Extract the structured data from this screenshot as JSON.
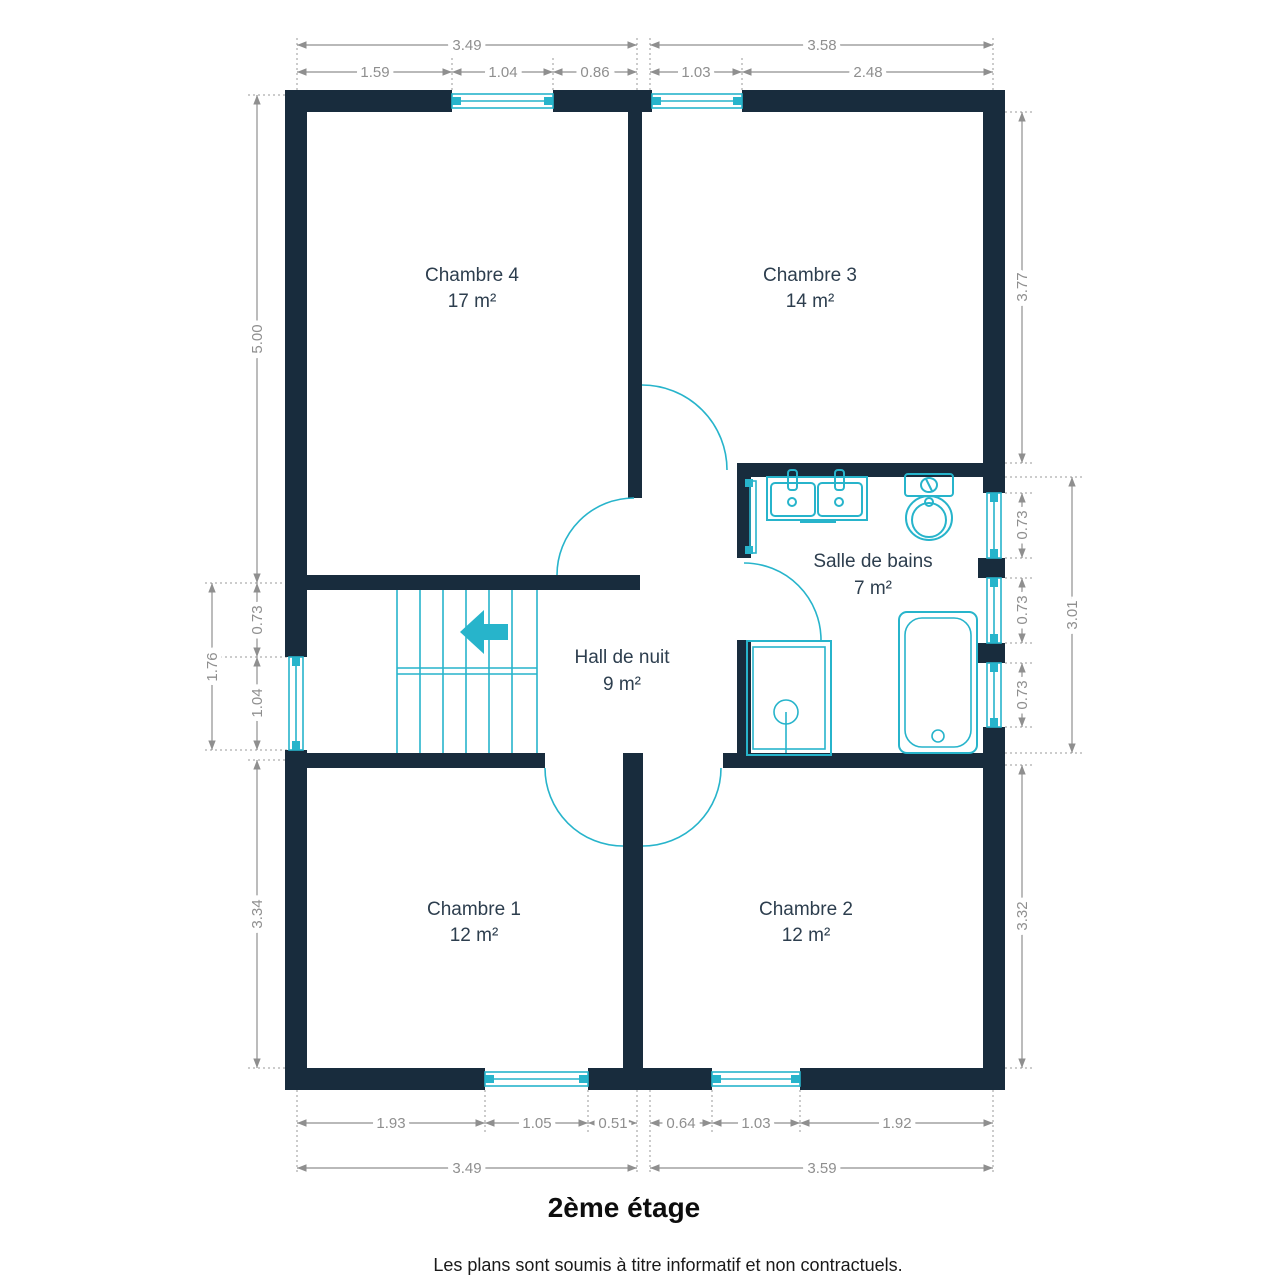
{
  "title": "2ème étage",
  "disclaimer": "Les plans sont soumis à titre informatif et non contractuels.",
  "rooms": {
    "chambre4": {
      "name": "Chambre 4",
      "area": "17 m²"
    },
    "chambre3": {
      "name": "Chambre 3",
      "area": "14 m²"
    },
    "salle_de_bains": {
      "name": "Salle de bains",
      "area": "7 m²"
    },
    "hall_de_nuit": {
      "name": "Hall de nuit",
      "area": "9 m²"
    },
    "chambre1": {
      "name": "Chambre 1",
      "area": "12 m²"
    },
    "chambre2": {
      "name": "Chambre 2",
      "area": "12 m²"
    }
  },
  "dimensions": {
    "top_outer_left": "3.49",
    "top_outer_right": "3.58",
    "top_inner": [
      "1.59",
      "1.04",
      "0.86",
      "1.03",
      "2.48"
    ],
    "bottom_inner": [
      "1.93",
      "1.05",
      "0.51",
      "0.64",
      "1.03",
      "1.92"
    ],
    "bottom_outer_left": "3.49",
    "bottom_outer_right": "3.59",
    "left_inner": [
      "5.00",
      "0.73",
      "1.04",
      "3.34"
    ],
    "left_outer": "1.76",
    "right_inner": [
      "3.77",
      "0.73",
      "0.73",
      "0.73",
      "3.32"
    ],
    "right_outer": "3.01"
  },
  "colors": {
    "wall": "#182c3d",
    "fixture_cyan": "#27b4cb",
    "dimension_gray": "#8f8f8f",
    "room_label": "#2d3e4e"
  }
}
